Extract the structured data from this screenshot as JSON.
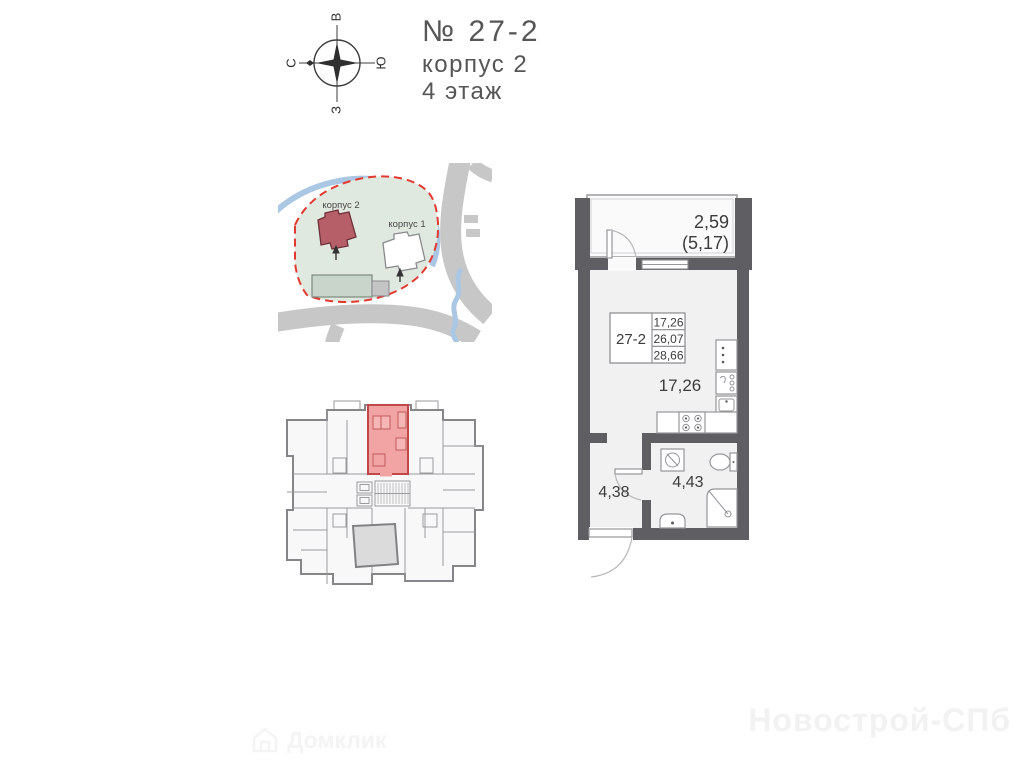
{
  "header": {
    "unit_number": "№ 27-2",
    "building": "корпус 2",
    "floor": "4 этаж"
  },
  "compass": {
    "top": "В",
    "right": "Ю",
    "bottom": "З",
    "left": "С"
  },
  "site_plan": {
    "building_2_label": "корпус 2",
    "building_1_label": "корпус 1",
    "colors": {
      "parcel": "#e0e9e0",
      "boundary": "#e23a31",
      "building_2": "#b65f68",
      "road": "#c7c7c7",
      "river": "#aac7e3"
    }
  },
  "floor_plan": {
    "colors": {
      "highlight_fill": "#f2a3a3",
      "highlight_stroke": "#c04848",
      "walls": "#85858a"
    }
  },
  "apartment": {
    "unit_label": "27-2",
    "info_table": {
      "living_area": "17,26",
      "area_no_balcony": "26,07",
      "total_area": "28,66"
    },
    "balcony_area": "2,59",
    "balcony_area_full": "(5,17)",
    "living_room_area": "17,26",
    "hall_area": "4,38",
    "bathroom_area": "4,43",
    "colors": {
      "walls": "#5f5f63",
      "floor": "#f1f1f2"
    }
  },
  "watermarks": {
    "brand": "Новострой-СПб",
    "portal": "Домклик"
  }
}
